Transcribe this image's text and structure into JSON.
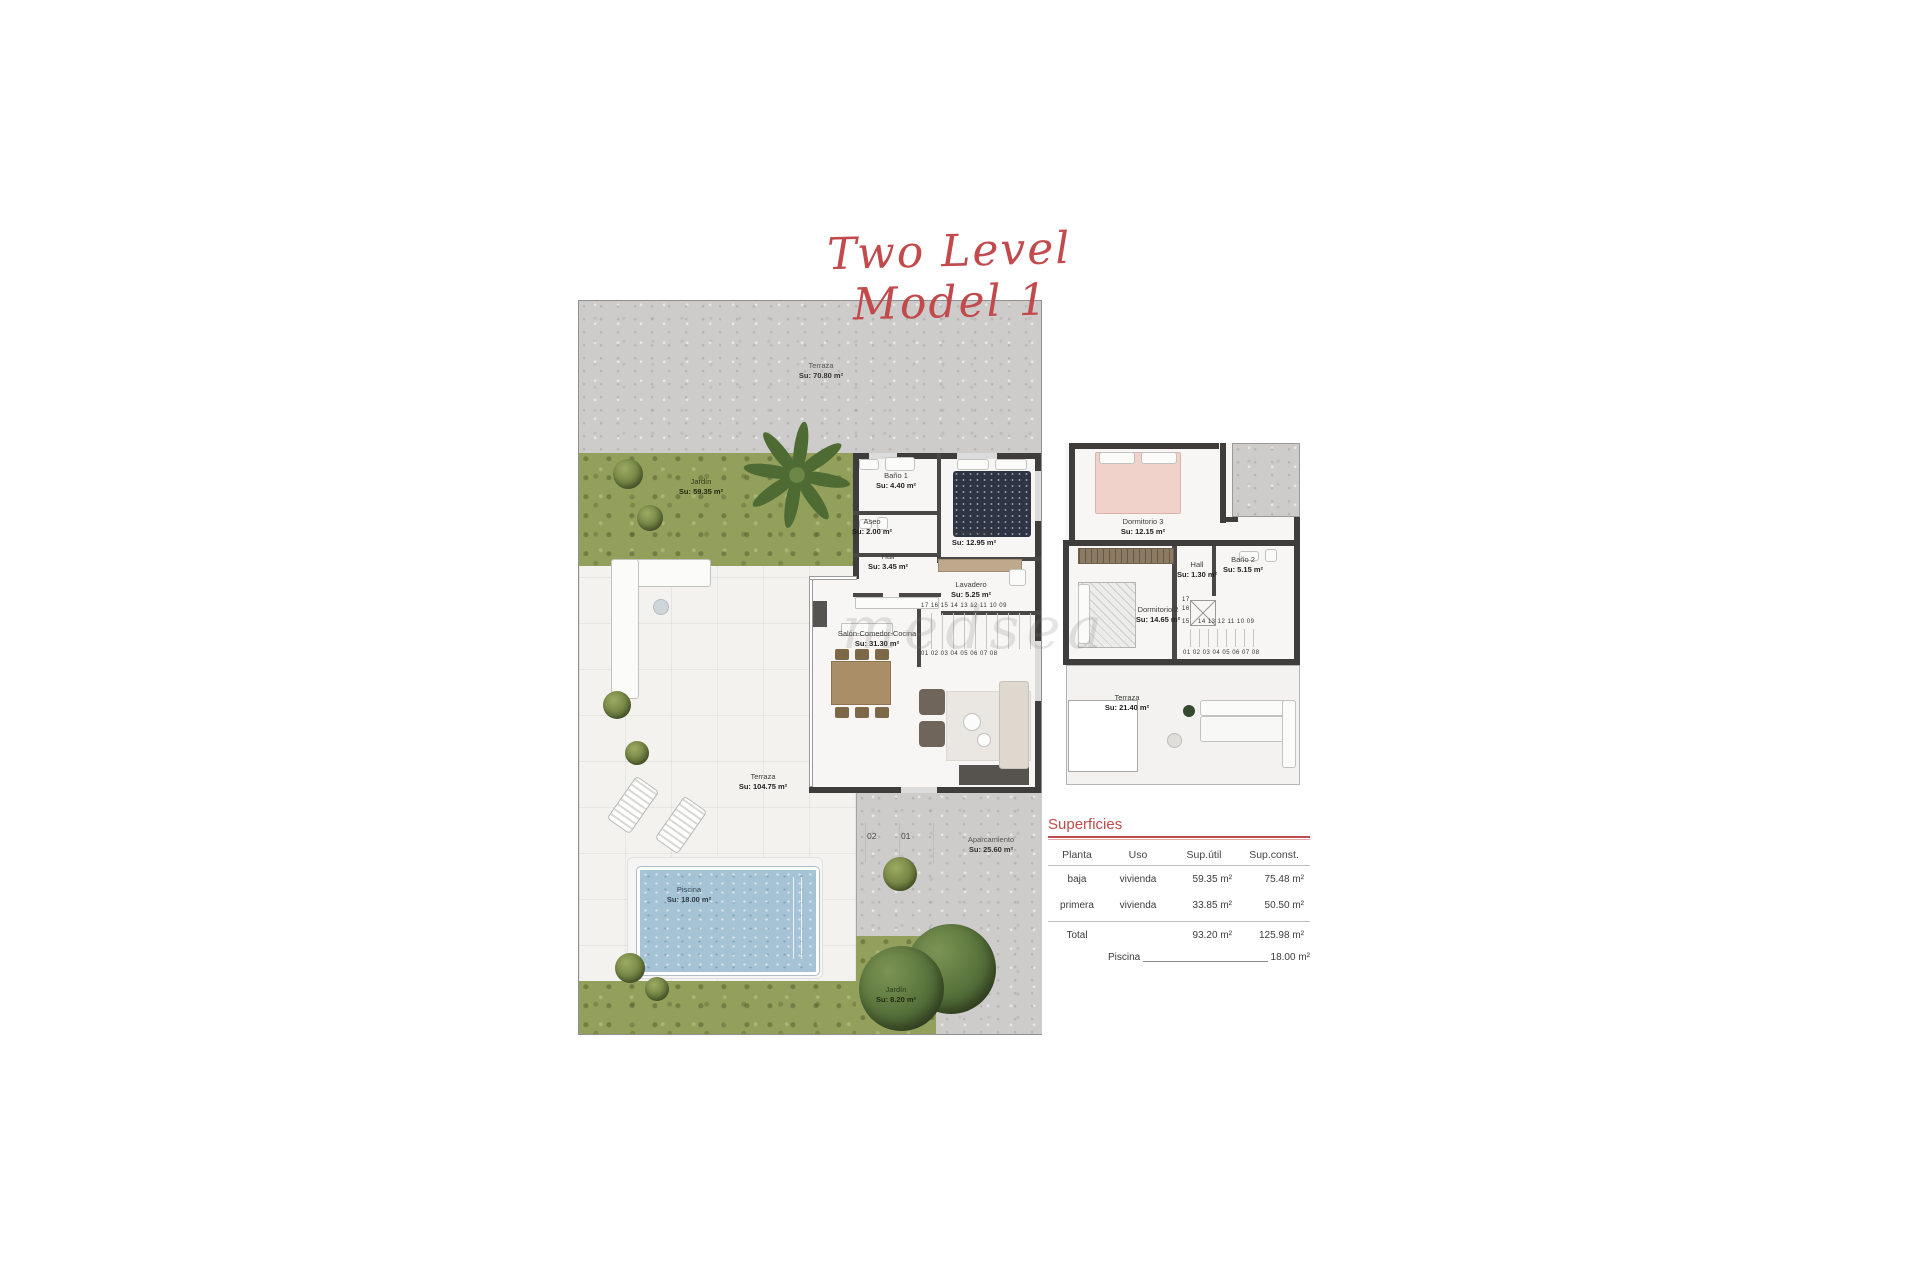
{
  "title": {
    "text": "Two Level Model 1"
  },
  "watermark": "medsea",
  "colors": {
    "accent_red": "#c24a4d",
    "grass": "#93a05c",
    "concrete": "#cdccca",
    "pool": "#a6c2d5",
    "wall": "#3f3d3b"
  },
  "gf": {
    "rooms": [
      {
        "name": "Terraza",
        "area": "Su: 70.80 m²"
      },
      {
        "name": "Jardín",
        "area": "Su: 59.35 m²"
      },
      {
        "name": "Baño 1",
        "area": "Su: 4.40 m²"
      },
      {
        "name": "Aseo",
        "area": "Su: 2.00 m²"
      },
      {
        "name": "Dormitorio 1",
        "area": "Su: 12.95 m²"
      },
      {
        "name": "Hall",
        "area": "Su: 3.45 m²"
      },
      {
        "name": "Lavadero",
        "area": "Su: 5.25 m²"
      },
      {
        "name": "Salón-Comedor-Cocina",
        "area": "Su: 31.30 m²"
      },
      {
        "name": "Terraza",
        "area": "Su: 104.75 m²"
      },
      {
        "name": "Piscina",
        "area": "Su: 18.00 m²"
      },
      {
        "name": "Aparcamiento",
        "area": "Su: 25.60 m²"
      },
      {
        "name": "Jardín",
        "area": "Su: 8.20 m²"
      }
    ],
    "stairs_top": "17 16 15 14 13 12 11 10 09",
    "stairs_bottom": "01 02 03 04 05 06 07 08",
    "parking": [
      "02",
      "01"
    ]
  },
  "ff": {
    "rooms": [
      {
        "name": "Dormitorio 3",
        "area": "Su: 12.15 m²"
      },
      {
        "name": "Hall",
        "area": "Su: 1.30 m²"
      },
      {
        "name": "Baño 2",
        "area": "Su: 5.15 m²"
      },
      {
        "name": "Dormitorio 2",
        "area": "Su: 14.65 m²"
      },
      {
        "name": "Terraza",
        "area": "Su: 21.40 m²"
      }
    ],
    "stairs_side": [
      "17",
      "16",
      "15"
    ],
    "stairs_mid": "14 13 12 11 10 09",
    "stairs_bottom": "01 02 03 04 05 06 07 08"
  },
  "table": {
    "title": "Superficies",
    "headers": [
      "Planta",
      "Uso",
      "Sup.útil",
      "Sup.const."
    ],
    "rows": [
      {
        "planta": "baja",
        "uso": "vivienda",
        "util": "59.35 m²",
        "const": "75.48 m²"
      },
      {
        "planta": "primera",
        "uso": "vivienda",
        "util": "33.85 m²",
        "const": "50.50 m²"
      }
    ],
    "total": {
      "label": "Total",
      "util": "93.20 m²",
      "const": "125.98 m²"
    },
    "piscina": {
      "label": "Piscina",
      "value": "18.00 m²"
    }
  }
}
